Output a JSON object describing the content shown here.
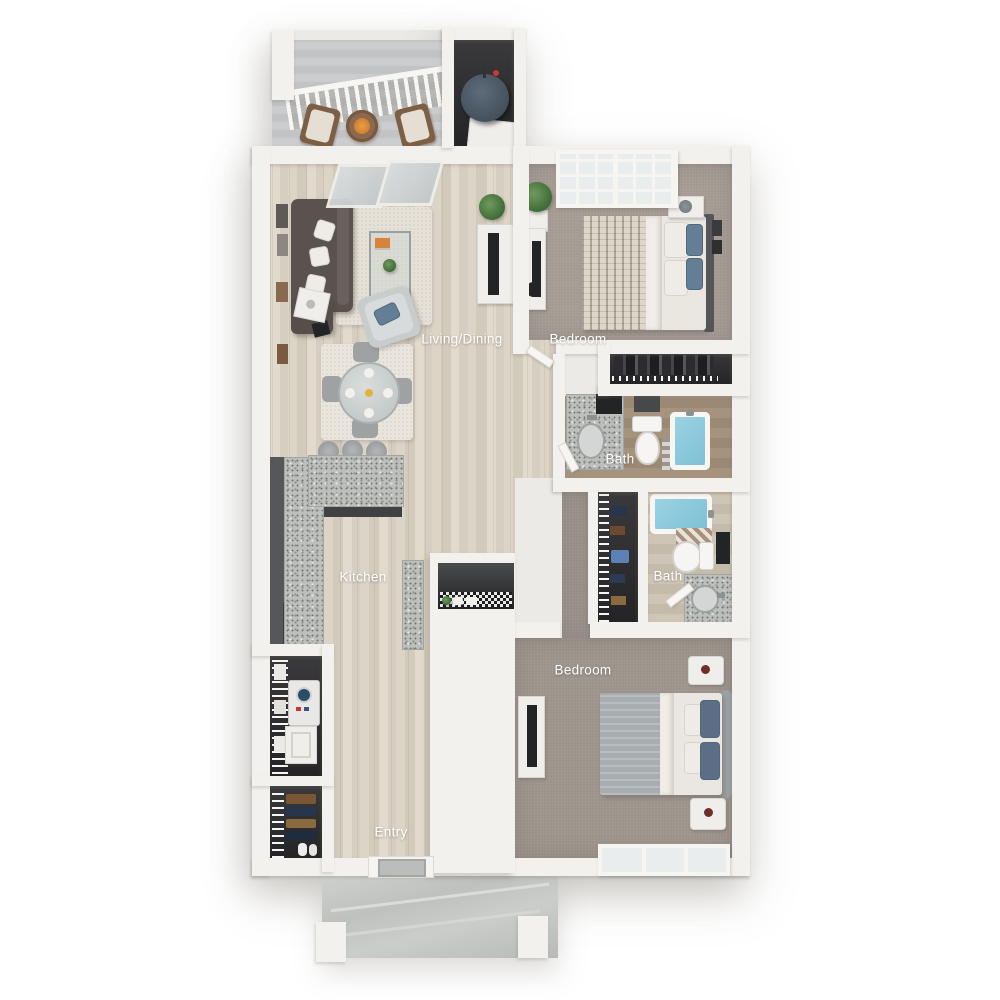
{
  "labels": {
    "living_dining": "Living/Dining",
    "bedroom_top": "Bedroom",
    "bath_top": "Bath",
    "bath_bottom": "Bath",
    "kitchen": "Kitchen",
    "bedroom_bottom": "Bedroom",
    "entry": "Entry"
  },
  "colors": {
    "background": "#ffffff",
    "wall": "#f2f1ee",
    "wood_floor": "#d7d0c2",
    "carpet": "#a49b93",
    "granite_counter": "#bdbfbc",
    "bathtub_blue": "#85c6da",
    "dark_cabinet": "#4c4e50",
    "sofa": "#5a524e",
    "accent_pillow_blue": "#647e95",
    "label_text": "#ffffff"
  }
}
